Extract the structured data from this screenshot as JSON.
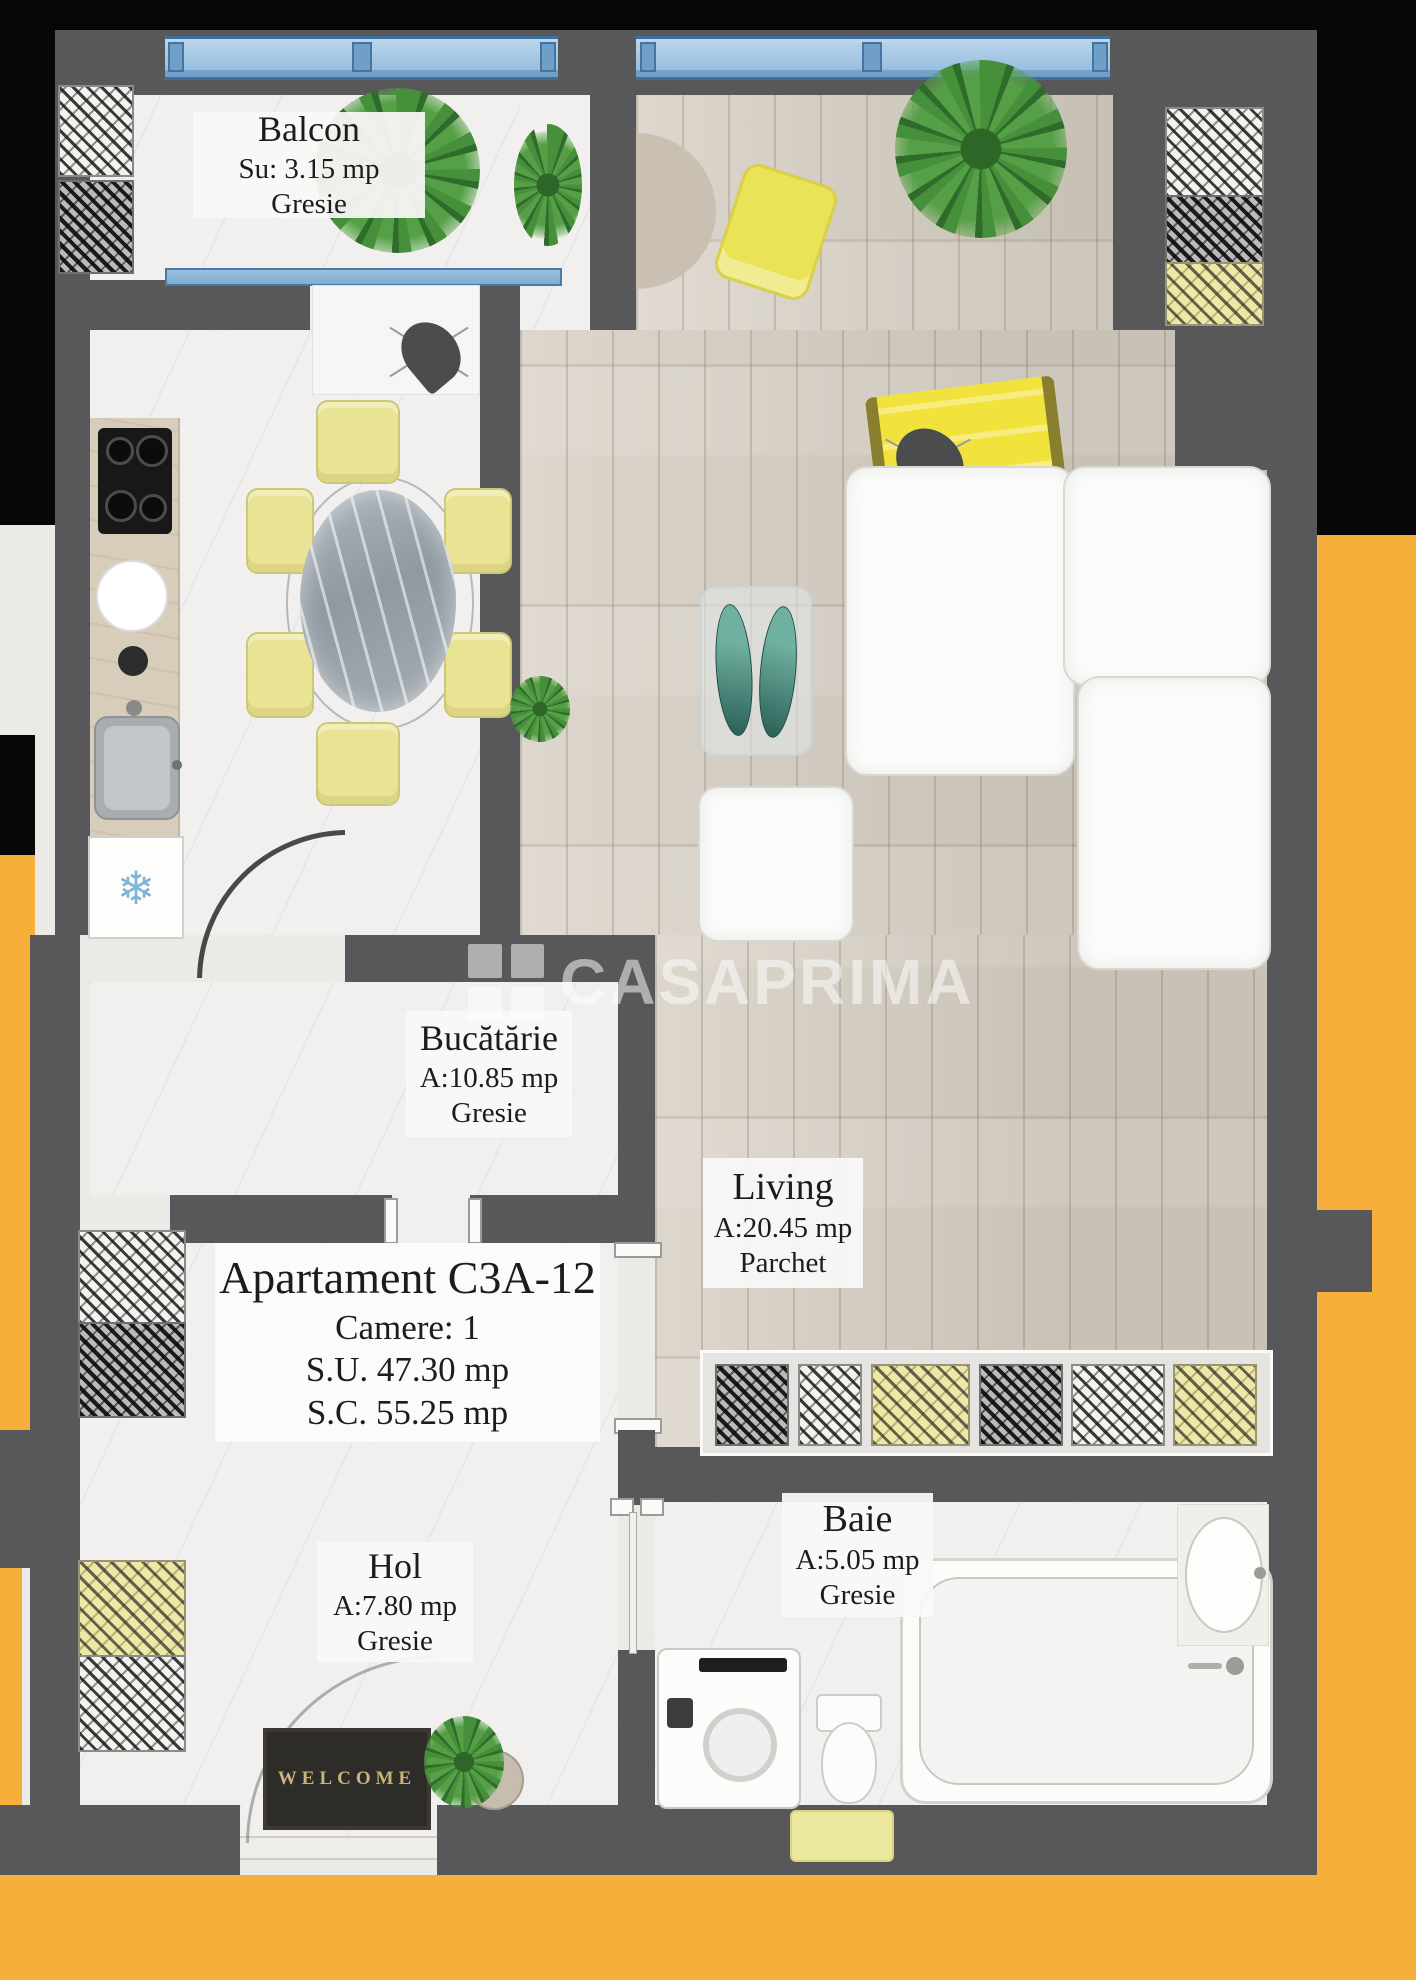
{
  "plan": {
    "watermark": {
      "text": "CASAPRIMA",
      "logo_icon": "grid-logo-icon"
    },
    "apartment": {
      "title": "Apartament C3A-12",
      "rooms_line": "Camere: 1",
      "usable_area": "S.U. 47.30 mp",
      "built_area": "S.C. 55.25 mp"
    },
    "rooms": {
      "balcon": {
        "name": "Balcon",
        "area": "Su: 3.15 mp",
        "floor": "Gresie"
      },
      "bucatarie": {
        "name": "Bucătărie",
        "area": "A:10.85 mp",
        "floor": "Gresie"
      },
      "living": {
        "name": "Living",
        "area": "A:20.45 mp",
        "floor": "Parchet"
      },
      "hol": {
        "name": "Hol",
        "area": "A:7.80 mp",
        "floor": "Gresie"
      },
      "baie": {
        "name": "Baie",
        "area": "A:5.05 mp",
        "floor": "Gresie"
      }
    },
    "entrance_mat": "WELCOME",
    "icons": {
      "freezer": "❄"
    },
    "colors": {
      "background_yellow": "#F5AF3A",
      "background_black": "#070707",
      "wall_gray": "#58585A",
      "window_blue": "#8FB9DD",
      "chair_yellow": "#E9E494",
      "lounge_yellow": "#F0E13C",
      "plant_green": "#47903B"
    }
  }
}
